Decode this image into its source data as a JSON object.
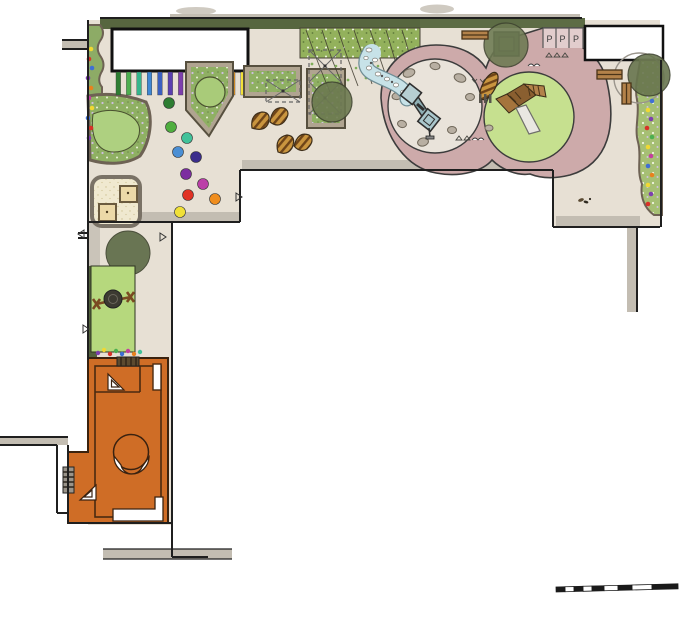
{
  "labels": {
    "parking": [
      "P",
      "P",
      "P"
    ]
  },
  "palette": {
    "paving": "#e7e0d4",
    "path_pink": "#cdaaaa",
    "ring_interior": "#e9e3da",
    "grass_mound": "#c6e08f",
    "lawn": "#b6d87d",
    "planting_green": "#8fb063",
    "hedge_dark": "#57663f",
    "tree_olive": "#5f6c49",
    "wood": "#b3824a",
    "water_blue": "#c7e2e8",
    "sand": "#f1ead0",
    "orange_room": "#cf6d26",
    "wall_grey": "#c3bdb2",
    "outline": "#1f1f1f"
  },
  "rainbow_posts": [
    {
      "x": 116.0,
      "y": 72,
      "width": 4.6,
      "height": 23,
      "fill": "#2e7d32"
    },
    {
      "x": 126.4,
      "y": 72,
      "width": 4.6,
      "height": 23,
      "fill": "#4caf50"
    },
    {
      "x": 136.8,
      "y": 72,
      "width": 4.6,
      "height": 23,
      "fill": "#35b58c"
    },
    {
      "x": 147.2,
      "y": 72,
      "width": 4.6,
      "height": 23,
      "fill": "#3f87d4"
    },
    {
      "x": 157.6,
      "y": 72,
      "width": 4.6,
      "height": 23,
      "fill": "#3a5fc0"
    },
    {
      "x": 168.0,
      "y": 72,
      "width": 4.6,
      "height": 23,
      "fill": "#5a3fb0"
    },
    {
      "x": 178.4,
      "y": 72,
      "width": 4.6,
      "height": 23,
      "fill": "#7d3fae"
    },
    {
      "x": 188.8,
      "y": 72,
      "width": 4.6,
      "height": 23,
      "fill": "#a23fa8"
    },
    {
      "x": 199.2,
      "y": 72,
      "width": 4.6,
      "height": 23,
      "fill": "#c43f9e"
    },
    {
      "x": 209.6,
      "y": 72,
      "width": 4.6,
      "height": 23,
      "fill": "#d83232"
    },
    {
      "x": 220.0,
      "y": 72,
      "width": 4.6,
      "height": 23,
      "fill": "#e8641e"
    },
    {
      "x": 230.4,
      "y": 72,
      "width": 4.6,
      "height": 23,
      "fill": "#f09c1e"
    },
    {
      "x": 240.8,
      "y": 72,
      "width": 4.6,
      "height": 23,
      "fill": "#f2e038"
    }
  ],
  "stepping_stones": [
    {
      "cx": 169,
      "cy": 103,
      "r": 5.5,
      "fill": "#2e7d32"
    },
    {
      "cx": 171,
      "cy": 127,
      "r": 5.5,
      "fill": "#4fae3e"
    },
    {
      "cx": 187,
      "cy": 138,
      "r": 5.5,
      "fill": "#41c29a"
    },
    {
      "cx": 178,
      "cy": 152,
      "r": 5.5,
      "fill": "#4b8fd4"
    },
    {
      "cx": 196,
      "cy": 157,
      "r": 5.5,
      "fill": "#3b2d8c"
    },
    {
      "cx": 186,
      "cy": 174,
      "r": 5.5,
      "fill": "#7c2ea0"
    },
    {
      "cx": 203,
      "cy": 184,
      "r": 5.5,
      "fill": "#bb3fa8"
    },
    {
      "cx": 188,
      "cy": 195,
      "r": 5.5,
      "fill": "#e03224"
    },
    {
      "cx": 215,
      "cy": 199,
      "r": 5.5,
      "fill": "#ef8d1e"
    },
    {
      "cx": 180,
      "cy": 212,
      "r": 5.5,
      "fill": "#f0e038"
    }
  ],
  "left_border_flowers": [
    {
      "cx": 91,
      "cy": 49,
      "r": 2.3,
      "fill": "#f0d832"
    },
    {
      "cx": 89,
      "cy": 59,
      "r": 2.3,
      "fill": "#d83228"
    },
    {
      "cx": 92,
      "cy": 68,
      "r": 2.3,
      "fill": "#3f6fd4"
    },
    {
      "cx": 88,
      "cy": 78,
      "r": 2.3,
      "fill": "#7d3fae"
    },
    {
      "cx": 91,
      "cy": 88,
      "r": 2.3,
      "fill": "#e8821e"
    },
    {
      "cx": 89,
      "cy": 98,
      "r": 2.3,
      "fill": "#c43f9e"
    },
    {
      "cx": 92,
      "cy": 108,
      "r": 2.3,
      "fill": "#f0d832"
    },
    {
      "cx": 88,
      "cy": 118,
      "r": 2.3,
      "fill": "#3f6fd4"
    },
    {
      "cx": 91,
      "cy": 128,
      "r": 2.3,
      "fill": "#d83228"
    },
    {
      "cx": 89,
      "cy": 138,
      "r": 2.3,
      "fill": "#7d3fae"
    }
  ],
  "lawn_flower_row": [
    {
      "cx": 98,
      "cy": 353,
      "r": 2.2,
      "fill": "#7d3fae"
    },
    {
      "cx": 104,
      "cy": 350,
      "r": 2.2,
      "fill": "#f0d832"
    },
    {
      "cx": 110,
      "cy": 354,
      "r": 2.2,
      "fill": "#d83228"
    },
    {
      "cx": 116,
      "cy": 351,
      "r": 2.2,
      "fill": "#4caf50"
    },
    {
      "cx": 122,
      "cy": 354,
      "r": 2.2,
      "fill": "#3f6fd4"
    },
    {
      "cx": 128,
      "cy": 351,
      "r": 2.2,
      "fill": "#c43f9e"
    },
    {
      "cx": 134,
      "cy": 354,
      "r": 2.2,
      "fill": "#e8821e"
    },
    {
      "cx": 140,
      "cy": 352,
      "r": 2.2,
      "fill": "#41c29a"
    }
  ],
  "right_border_flowers": [
    {
      "cx": 652,
      "cy": 101,
      "r": 2.3,
      "fill": "#3f6fd4"
    },
    {
      "cx": 648,
      "cy": 110,
      "r": 2.3,
      "fill": "#f0d832"
    },
    {
      "cx": 651,
      "cy": 119,
      "r": 2.3,
      "fill": "#7d3fae"
    },
    {
      "cx": 647,
      "cy": 128,
      "r": 2.3,
      "fill": "#d83228"
    },
    {
      "cx": 652,
      "cy": 137,
      "r": 2.3,
      "fill": "#4caf50"
    },
    {
      "cx": 648,
      "cy": 147,
      "r": 2.3,
      "fill": "#f0d832"
    },
    {
      "cx": 651,
      "cy": 156,
      "r": 2.3,
      "fill": "#c43f9e"
    },
    {
      "cx": 648,
      "cy": 166,
      "r": 2.3,
      "fill": "#3f6fd4"
    },
    {
      "cx": 652,
      "cy": 175,
      "r": 2.3,
      "fill": "#e8821e"
    },
    {
      "cx": 648,
      "cy": 185,
      "r": 2.3,
      "fill": "#f0d832"
    },
    {
      "cx": 651,
      "cy": 194,
      "r": 2.3,
      "fill": "#7d3fae"
    },
    {
      "cx": 648,
      "cy": 204,
      "r": 2.3,
      "fill": "#d83228"
    }
  ],
  "scale_bar_segments": [
    {
      "x": 0,
      "y": 0,
      "width": 9,
      "height": 5,
      "fill": "#1a1a1a",
      "stroke": "#1a1a1a",
      "stroke-width": 0.8
    },
    {
      "x": 9,
      "y": 0,
      "width": 9,
      "height": 5,
      "fill": "#ffffff",
      "stroke": "#1a1a1a",
      "stroke-width": 0.8
    },
    {
      "x": 18,
      "y": 0,
      "width": 9,
      "height": 5,
      "fill": "#1a1a1a",
      "stroke": "#1a1a1a",
      "stroke-width": 0.8
    },
    {
      "x": 27,
      "y": 0,
      "width": 9,
      "height": 5,
      "fill": "#ffffff",
      "stroke": "#1a1a1a",
      "stroke-width": 0.8
    },
    {
      "x": 36,
      "y": 0,
      "width": 12,
      "height": 5,
      "fill": "#1a1a1a",
      "stroke": "#1a1a1a",
      "stroke-width": 0.8
    },
    {
      "x": 48,
      "y": 0,
      "width": 14,
      "height": 5,
      "fill": "#ffffff",
      "stroke": "#1a1a1a",
      "stroke-width": 0.8
    },
    {
      "x": 62,
      "y": 0,
      "width": 14,
      "height": 5,
      "fill": "#1a1a1a",
      "stroke": "#1a1a1a",
      "stroke-width": 0.8
    },
    {
      "x": 76,
      "y": 0,
      "width": 20,
      "height": 5,
      "fill": "#ffffff",
      "stroke": "#1a1a1a",
      "stroke-width": 0.8
    },
    {
      "x": 96,
      "y": 0,
      "width": 26,
      "height": 5,
      "fill": "#1a1a1a",
      "stroke": "#1a1a1a",
      "stroke-width": 0.8
    }
  ]
}
